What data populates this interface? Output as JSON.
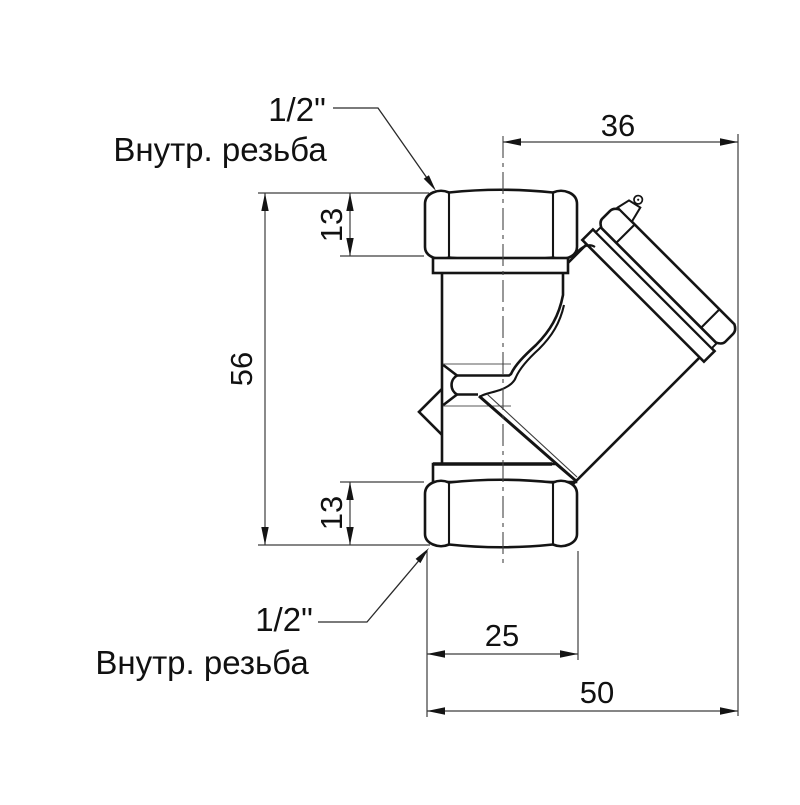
{
  "drawing": {
    "type": "technical-dimension-drawing",
    "subject": "Y-strainer pipe fitting, side view",
    "background_color": "#ffffff",
    "line_color": "#141414",
    "dimensions": {
      "top_offset": "36",
      "overall_height": "56",
      "top_nut_height": "13",
      "bottom_nut_height": "13",
      "bottom_port_width": "25",
      "overall_width": "50"
    },
    "labels": {
      "top_port": {
        "size": "1/2\"",
        "thread": "Внутр. резьба"
      },
      "bottom_port": {
        "size": "1/2\"",
        "thread": "Внутр. резьба"
      }
    }
  }
}
